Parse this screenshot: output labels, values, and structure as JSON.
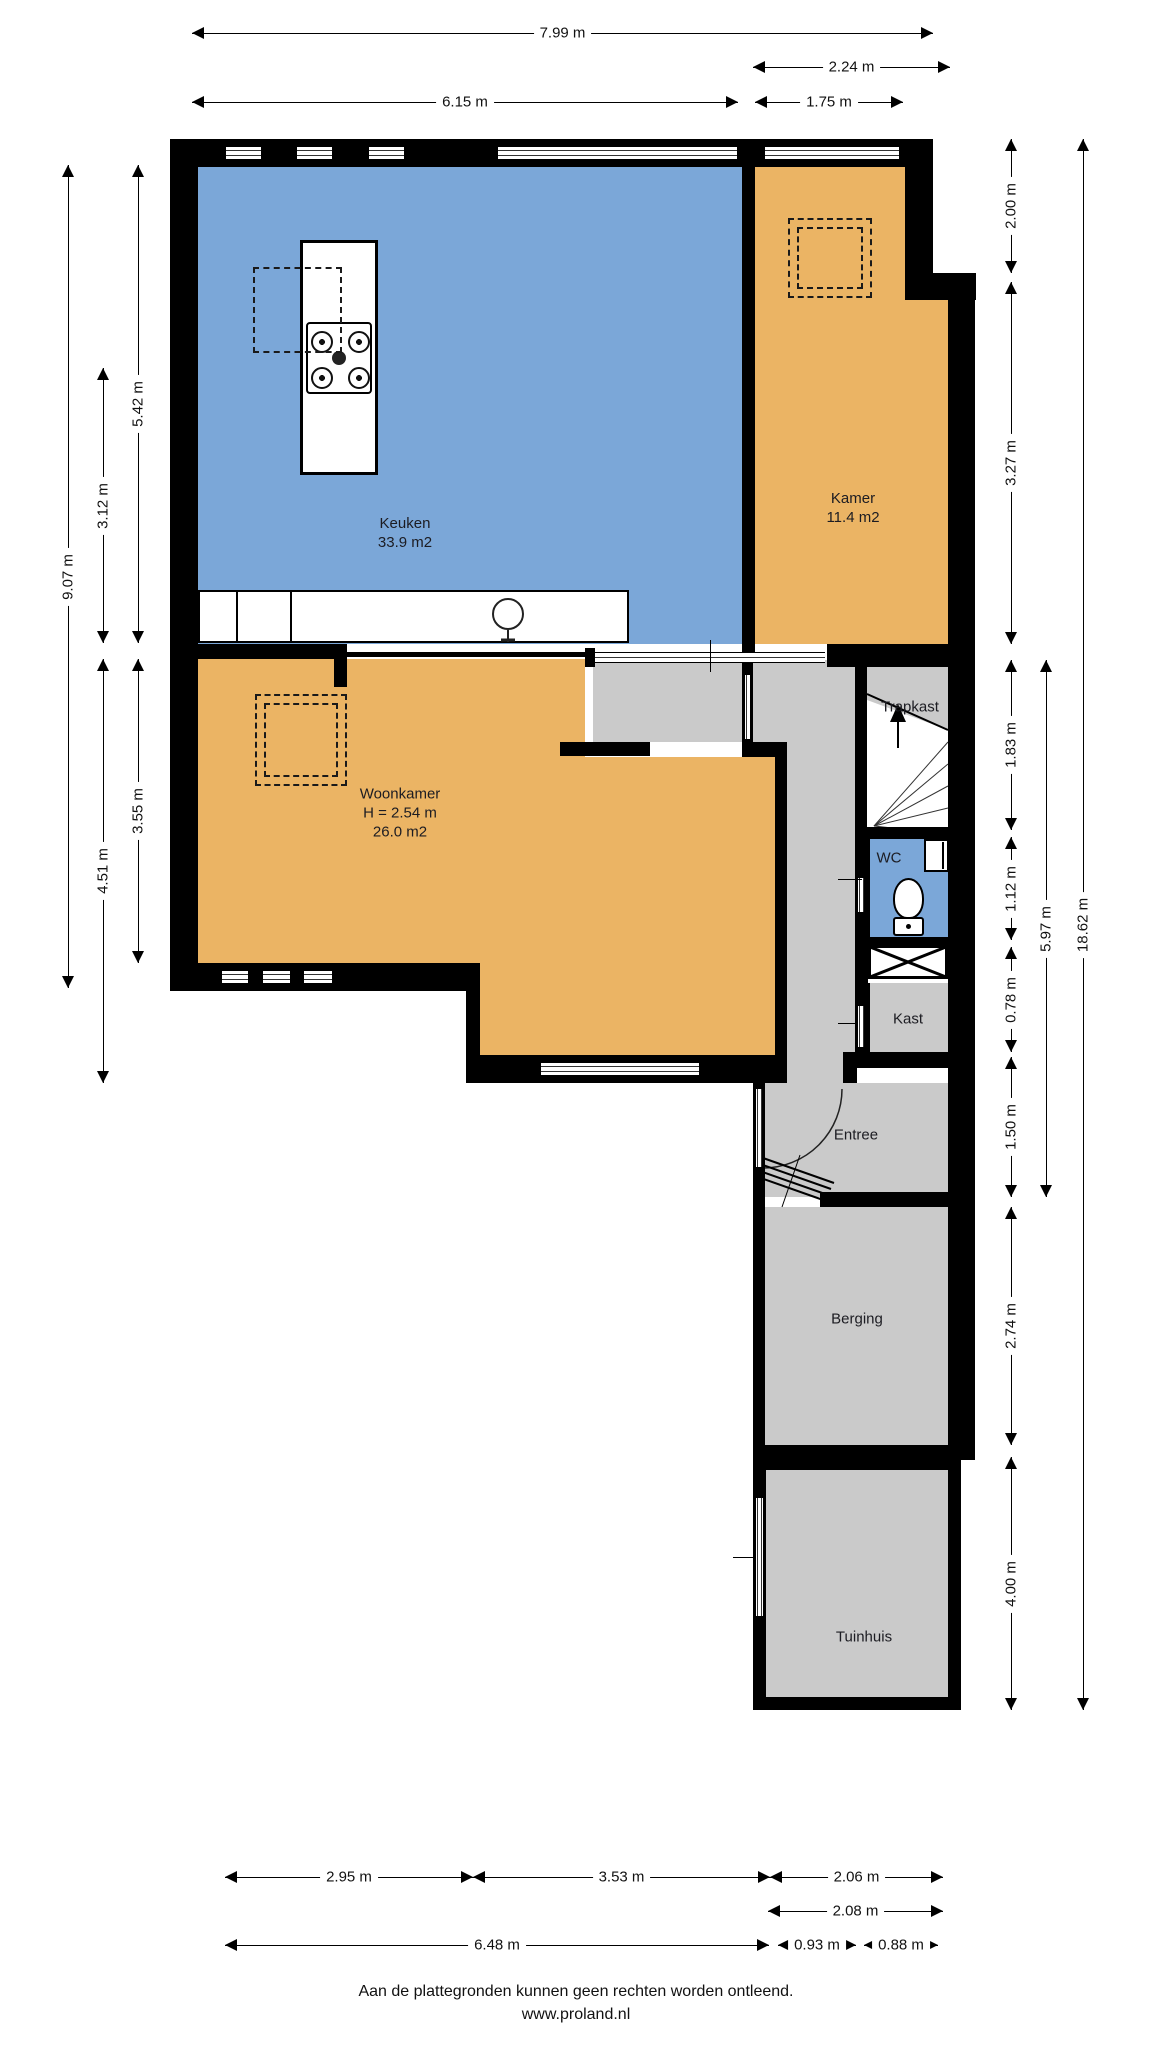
{
  "meta": {
    "footer_line1": "Aan de plattegronden kunnen geen rechten worden ontleend.",
    "footer_line2": "www.proland.nl"
  },
  "colors": {
    "kitchen_floor": "#7BA7D8",
    "room_floor": "#EBB464",
    "hall_floor": "#CACACA",
    "wc_floor": "#7BA7D8",
    "wall": "#000000",
    "background": "#FFFFFF"
  },
  "rooms": {
    "keuken": {
      "label": "Keuken",
      "area": "33.9 m2"
    },
    "kamer": {
      "label": "Kamer",
      "area": "11.4 m2"
    },
    "woonkamer": {
      "label": "Woonkamer",
      "height_note": "H = 2.54 m",
      "area": "26.0 m2"
    },
    "trapkast": {
      "label": "Trapkast"
    },
    "wc": {
      "label": "WC"
    },
    "kast": {
      "label": "Kast"
    },
    "entree": {
      "label": "Entree"
    },
    "berging": {
      "label": "Berging"
    },
    "tuinhuis": {
      "label": "Tuinhuis"
    }
  },
  "floors": [
    {
      "name": "keuken-floor",
      "x": 198,
      "y": 167,
      "w": 544,
      "h": 477,
      "c": "#7BA7D8"
    },
    {
      "name": "kamer-floor-upper",
      "x": 755,
      "y": 167,
      "w": 150,
      "h": 110,
      "c": "#EBB464"
    },
    {
      "name": "kamer-floor-lower",
      "x": 755,
      "y": 277,
      "w": 193,
      "h": 367,
      "c": "#EBB464"
    },
    {
      "name": "woonkamer-floor-a",
      "x": 198,
      "y": 659,
      "w": 387,
      "h": 98,
      "c": "#EBB464"
    },
    {
      "name": "woonkamer-floor-b",
      "x": 198,
      "y": 757,
      "w": 577,
      "h": 206,
      "c": "#EBB464"
    },
    {
      "name": "woonkamer-floor-c",
      "x": 466,
      "y": 963,
      "w": 309,
      "h": 92,
      "c": "#EBB464"
    },
    {
      "name": "hall-floor-upper",
      "x": 593,
      "y": 660,
      "w": 262,
      "h": 82,
      "c": "#CACACA"
    },
    {
      "name": "hall-floor-corridor",
      "x": 787,
      "y": 742,
      "w": 68,
      "h": 341,
      "c": "#CACACA"
    },
    {
      "name": "trapkast-floor",
      "x": 867,
      "y": 660,
      "w": 81,
      "h": 170,
      "c": "#CACACA"
    },
    {
      "name": "wc-floor",
      "x": 870,
      "y": 839,
      "w": 78,
      "h": 98,
      "c": "#7BA7D8"
    },
    {
      "name": "kast-floor",
      "x": 870,
      "y": 983,
      "w": 78,
      "h": 69,
      "c": "#CACACA"
    },
    {
      "name": "entree-floor",
      "x": 765,
      "y": 1083,
      "w": 183,
      "h": 114,
      "c": "#CACACA"
    },
    {
      "name": "berging-floor",
      "x": 765,
      "y": 1207,
      "w": 183,
      "h": 238,
      "c": "#CACACA"
    },
    {
      "name": "tuinhuis-floor",
      "x": 766,
      "y": 1470,
      "w": 182,
      "h": 227,
      "c": "#CACACA"
    }
  ],
  "walls": [
    [
      170,
      139,
      763,
      28
    ],
    [
      170,
      139,
      28,
      852
    ],
    [
      742,
      139,
      13,
      521
    ],
    [
      905,
      139,
      28,
      140
    ],
    [
      905,
      273,
      71,
      27
    ],
    [
      948,
      273,
      27,
      1184
    ],
    [
      170,
      644,
      177,
      15
    ],
    [
      334,
      651,
      13,
      36
    ],
    [
      347,
      652,
      240,
      5
    ],
    [
      585,
      648,
      10,
      19
    ],
    [
      827,
      644,
      121,
      23
    ],
    [
      742,
      660,
      11,
      84
    ],
    [
      560,
      742,
      90,
      14
    ],
    [
      742,
      742,
      45,
      15
    ],
    [
      775,
      757,
      12,
      326
    ],
    [
      466,
      963,
      14,
      120
    ],
    [
      170,
      963,
      310,
      28
    ],
    [
      466,
      1055,
      321,
      28
    ],
    [
      855,
      660,
      12,
      170
    ],
    [
      855,
      827,
      93,
      12
    ],
    [
      855,
      839,
      15,
      98
    ],
    [
      855,
      937,
      93,
      10
    ],
    [
      855,
      945,
      13,
      38
    ],
    [
      855,
      983,
      15,
      69
    ],
    [
      843,
      1052,
      107,
      16
    ],
    [
      843,
      1052,
      14,
      31
    ],
    [
      753,
      1083,
      12,
      114
    ],
    [
      753,
      1168,
      12,
      292
    ],
    [
      820,
      1192,
      128,
      15
    ],
    [
      753,
      1445,
      222,
      15
    ],
    [
      753,
      1457,
      208,
      13
    ],
    [
      753,
      1457,
      13,
      253
    ],
    [
      948,
      1457,
      13,
      253
    ],
    [
      753,
      1697,
      208,
      13
    ],
    [
      545,
      146,
      3,
      14
    ],
    [
      727,
      146,
      3,
      14
    ],
    [
      834,
      146,
      3,
      14
    ]
  ],
  "windows_h": [
    [
      225,
      146,
      37,
      14
    ],
    [
      296,
      146,
      37,
      14
    ],
    [
      368,
      146,
      37,
      14
    ],
    [
      497,
      146,
      241,
      14
    ],
    [
      764,
      146,
      136,
      14
    ],
    [
      221,
      970,
      28,
      14
    ],
    [
      262,
      970,
      29,
      14
    ],
    [
      303,
      970,
      30,
      14
    ],
    [
      540,
      1062,
      160,
      14
    ]
  ],
  "windows_v": [
    [
      755,
      1497,
      9,
      120
    ],
    [
      744,
      674,
      7,
      66
    ],
    [
      857,
      1005,
      8,
      43
    ],
    [
      857,
      877,
      8,
      36
    ],
    [
      755,
      1088,
      8,
      80
    ]
  ],
  "door_bands_h": [
    [
      595,
      652,
      230,
      11
    ]
  ],
  "ticks": [
    [
      710,
      640,
      1,
      32
    ],
    [
      838,
      879,
      24,
      1
    ],
    [
      838,
      1023,
      19,
      1
    ],
    [
      733,
      1557,
      20,
      1
    ]
  ],
  "dashed_rects": [
    {
      "name": "keuken-dashed-outline",
      "x": 253,
      "y": 267,
      "w": 89,
      "h": 86,
      "double": false
    },
    {
      "name": "kamer-dashed-outline",
      "x": 788,
      "y": 218,
      "w": 84,
      "h": 80,
      "double": true
    },
    {
      "name": "woonkamer-dashed-outline",
      "x": 255,
      "y": 694,
      "w": 92,
      "h": 92,
      "double": true
    }
  ],
  "labels": [
    {
      "name": "keuken-label",
      "x": 405,
      "y": 533,
      "lines": [
        "Keuken",
        "33.9 m2"
      ]
    },
    {
      "name": "kamer-label",
      "x": 853,
      "y": 508,
      "lines": [
        "Kamer",
        "11.4 m2"
      ]
    },
    {
      "name": "woonkamer-label",
      "x": 400,
      "y": 813,
      "lines": [
        "Woonkamer",
        "H = 2.54 m",
        "26.0 m2"
      ]
    },
    {
      "name": "trapkast-label",
      "x": 910,
      "y": 707,
      "lines": [
        "Trapkast"
      ]
    },
    {
      "name": "wc-label",
      "x": 889,
      "y": 858,
      "lines": [
        "WC"
      ]
    },
    {
      "name": "kast-label",
      "x": 908,
      "y": 1019,
      "lines": [
        "Kast"
      ]
    },
    {
      "name": "entree-label",
      "x": 856,
      "y": 1135,
      "lines": [
        "Entree"
      ]
    },
    {
      "name": "berging-label",
      "x": 857,
      "y": 1319,
      "lines": [
        "Berging"
      ]
    },
    {
      "name": "tuinhuis-label",
      "x": 864,
      "y": 1637,
      "lines": [
        "Tuinhuis"
      ]
    }
  ],
  "dimensions": [
    {
      "name": "dim-top-799",
      "dir": "h",
      "pos": 33,
      "a": 192,
      "b": 933,
      "label": "7.99 m"
    },
    {
      "name": "dim-top-224",
      "dir": "h",
      "pos": 67,
      "a": 753,
      "b": 950,
      "label": "2.24 m"
    },
    {
      "name": "dim-top-615",
      "dir": "h",
      "pos": 102,
      "a": 192,
      "b": 738,
      "label": "6.15 m"
    },
    {
      "name": "dim-top-175",
      "dir": "h",
      "pos": 102,
      "a": 755,
      "b": 903,
      "label": "1.75 m"
    },
    {
      "name": "dim-left-907",
      "dir": "v",
      "pos": 68,
      "a": 165,
      "b": 988,
      "label": "9.07 m"
    },
    {
      "name": "dim-left-312",
      "dir": "v",
      "pos": 103,
      "a": 368,
      "b": 643,
      "label": "3.12 m"
    },
    {
      "name": "dim-left-451",
      "dir": "v",
      "pos": 103,
      "a": 659,
      "b": 1083,
      "label": "4.51 m"
    },
    {
      "name": "dim-left-542",
      "dir": "v",
      "pos": 138,
      "a": 165,
      "b": 643,
      "label": "5.42 m"
    },
    {
      "name": "dim-left-355",
      "dir": "v",
      "pos": 138,
      "a": 659,
      "b": 963,
      "label": "3.55 m"
    },
    {
      "name": "dim-right-200",
      "dir": "v",
      "pos": 1011,
      "a": 139,
      "b": 273,
      "label": "2.00 m"
    },
    {
      "name": "dim-right-327",
      "dir": "v",
      "pos": 1011,
      "a": 282,
      "b": 644,
      "label": "3.27 m"
    },
    {
      "name": "dim-right-183",
      "dir": "v",
      "pos": 1011,
      "a": 660,
      "b": 830,
      "label": "1.83 m"
    },
    {
      "name": "dim-right-112",
      "dir": "v",
      "pos": 1011,
      "a": 837,
      "b": 940,
      "label": "1.12 m"
    },
    {
      "name": "dim-right-078",
      "dir": "v",
      "pos": 1011,
      "a": 947,
      "b": 1052,
      "label": "0.78 m"
    },
    {
      "name": "dim-right-150",
      "dir": "v",
      "pos": 1011,
      "a": 1057,
      "b": 1197,
      "label": "1.50 m"
    },
    {
      "name": "dim-right-274",
      "dir": "v",
      "pos": 1011,
      "a": 1207,
      "b": 1445,
      "label": "2.74 m"
    },
    {
      "name": "dim-right-400",
      "dir": "v",
      "pos": 1011,
      "a": 1457,
      "b": 1710,
      "label": "4.00 m"
    },
    {
      "name": "dim-right-597",
      "dir": "v",
      "pos": 1046,
      "a": 660,
      "b": 1197,
      "label": "5.97 m"
    },
    {
      "name": "dim-right-1862",
      "dir": "v",
      "pos": 1083,
      "a": 139,
      "b": 1710,
      "label": "18.62 m"
    },
    {
      "name": "dim-bottom-295",
      "dir": "h",
      "pos": 1877,
      "a": 225,
      "b": 473,
      "label": "2.95 m"
    },
    {
      "name": "dim-bottom-353",
      "dir": "h",
      "pos": 1877,
      "a": 473,
      "b": 770,
      "label": "3.53 m"
    },
    {
      "name": "dim-bottom-206",
      "dir": "h",
      "pos": 1877,
      "a": 770,
      "b": 943,
      "label": "2.06 m"
    },
    {
      "name": "dim-bottom-208",
      "dir": "h",
      "pos": 1911,
      "a": 768,
      "b": 943,
      "label": "2.08 m"
    },
    {
      "name": "dim-bottom-648",
      "dir": "h",
      "pos": 1945,
      "a": 225,
      "b": 769,
      "label": "6.48 m"
    },
    {
      "name": "dim-bottom-093",
      "dir": "h",
      "pos": 1945,
      "a": 778,
      "b": 856,
      "label": "0.93 m"
    },
    {
      "name": "dim-bottom-088",
      "dir": "h",
      "pos": 1945,
      "a": 864,
      "b": 938,
      "label": "0.88 m"
    }
  ]
}
